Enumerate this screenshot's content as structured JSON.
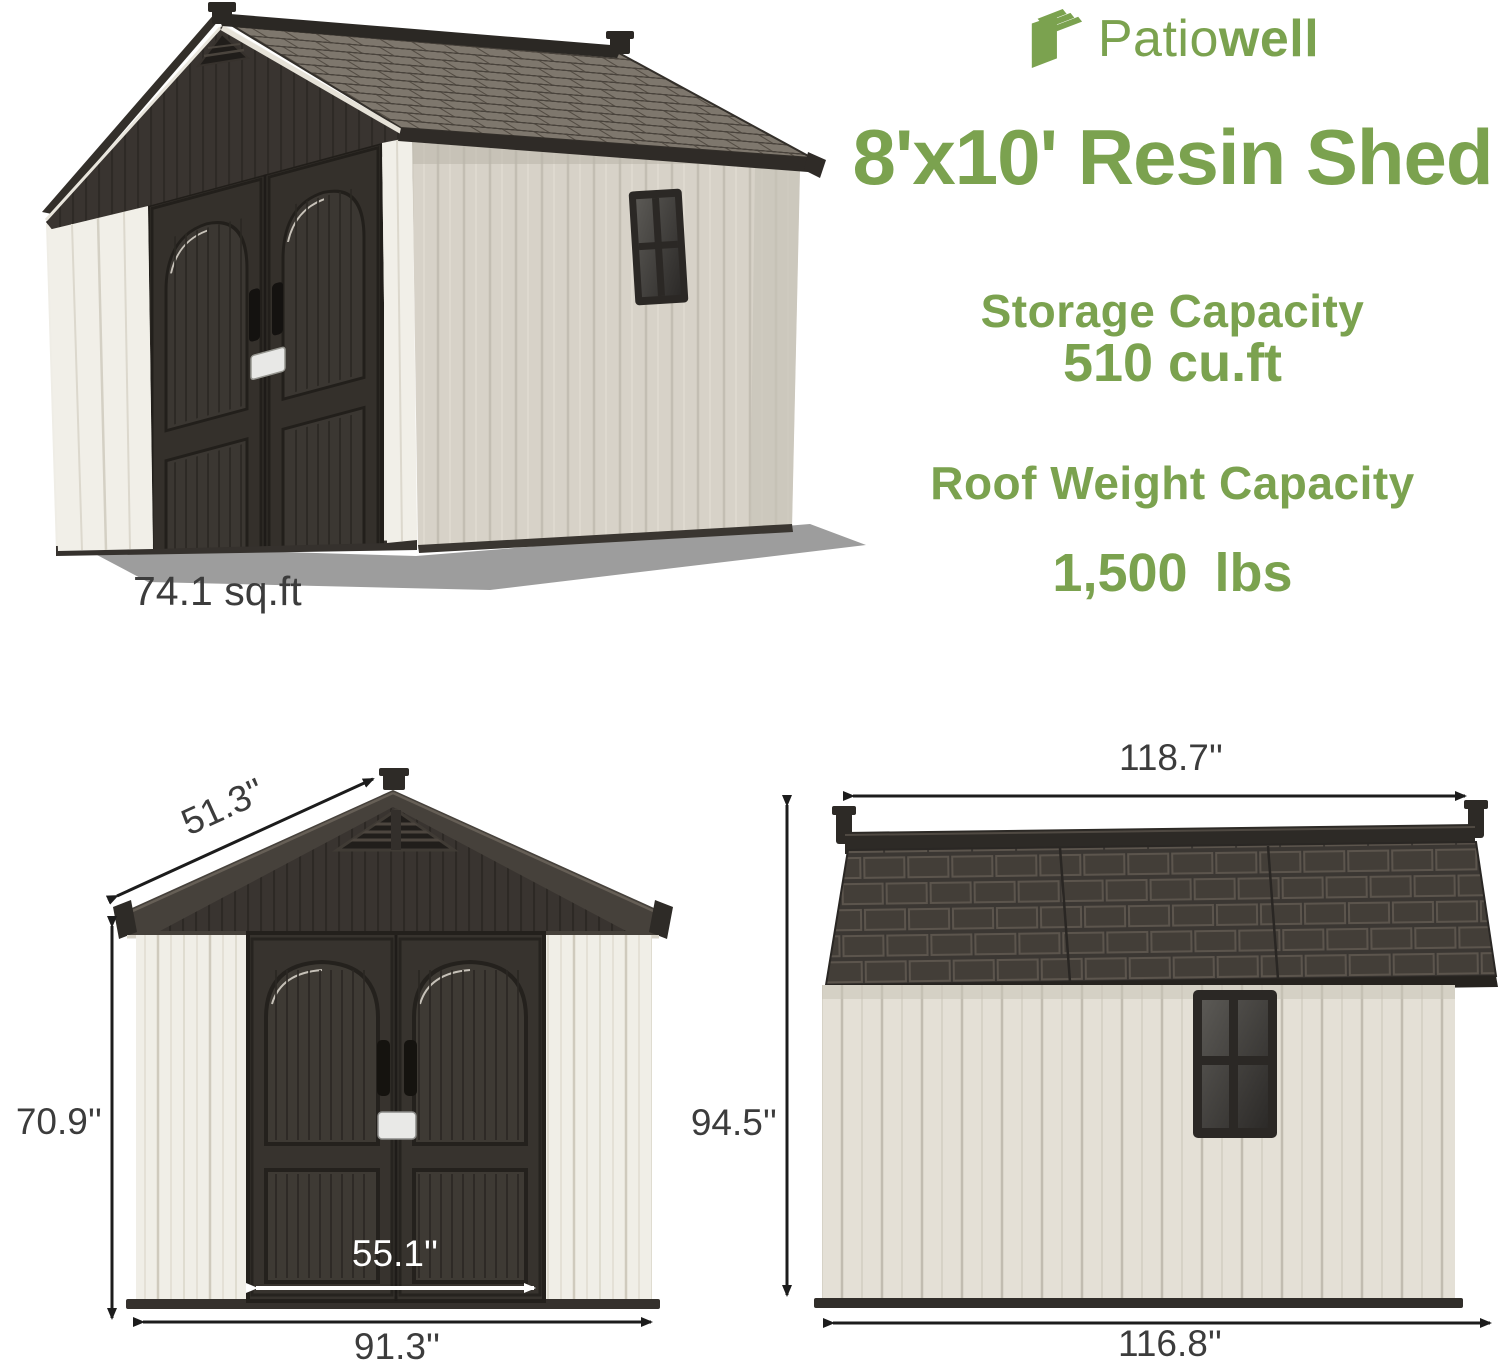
{
  "brand": {
    "logo_regular": "Patio",
    "logo_bold": "well",
    "accent_color": "#7ba24f"
  },
  "title": "8'x10' Resin Shed",
  "specs": [
    {
      "label": "Storage Capacity",
      "value": "510 cu.ft"
    },
    {
      "label": "Roof Weight Capacity",
      "value": "1,500 lbs"
    }
  ],
  "floor_area": "74.1 sq.ft",
  "dimensions": {
    "front_view": {
      "roof_slope": "51.3''",
      "wall_height": "70.9''",
      "door_width": "55.1''",
      "overall_width": "91.3''"
    },
    "side_view": {
      "roof_length": "118.7''",
      "overall_height": "94.5''",
      "wall_length": "116.8''"
    }
  },
  "colors": {
    "accent_green": "#7ba24f",
    "dimension_text": "#3c3c3c",
    "roof_dark": "#46413b",
    "door_dark": "#34302b",
    "wall_cream": "#f0eee7",
    "side_wall_greige": "#d7d2c8",
    "shadow_gray": "#9d9d9d"
  }
}
